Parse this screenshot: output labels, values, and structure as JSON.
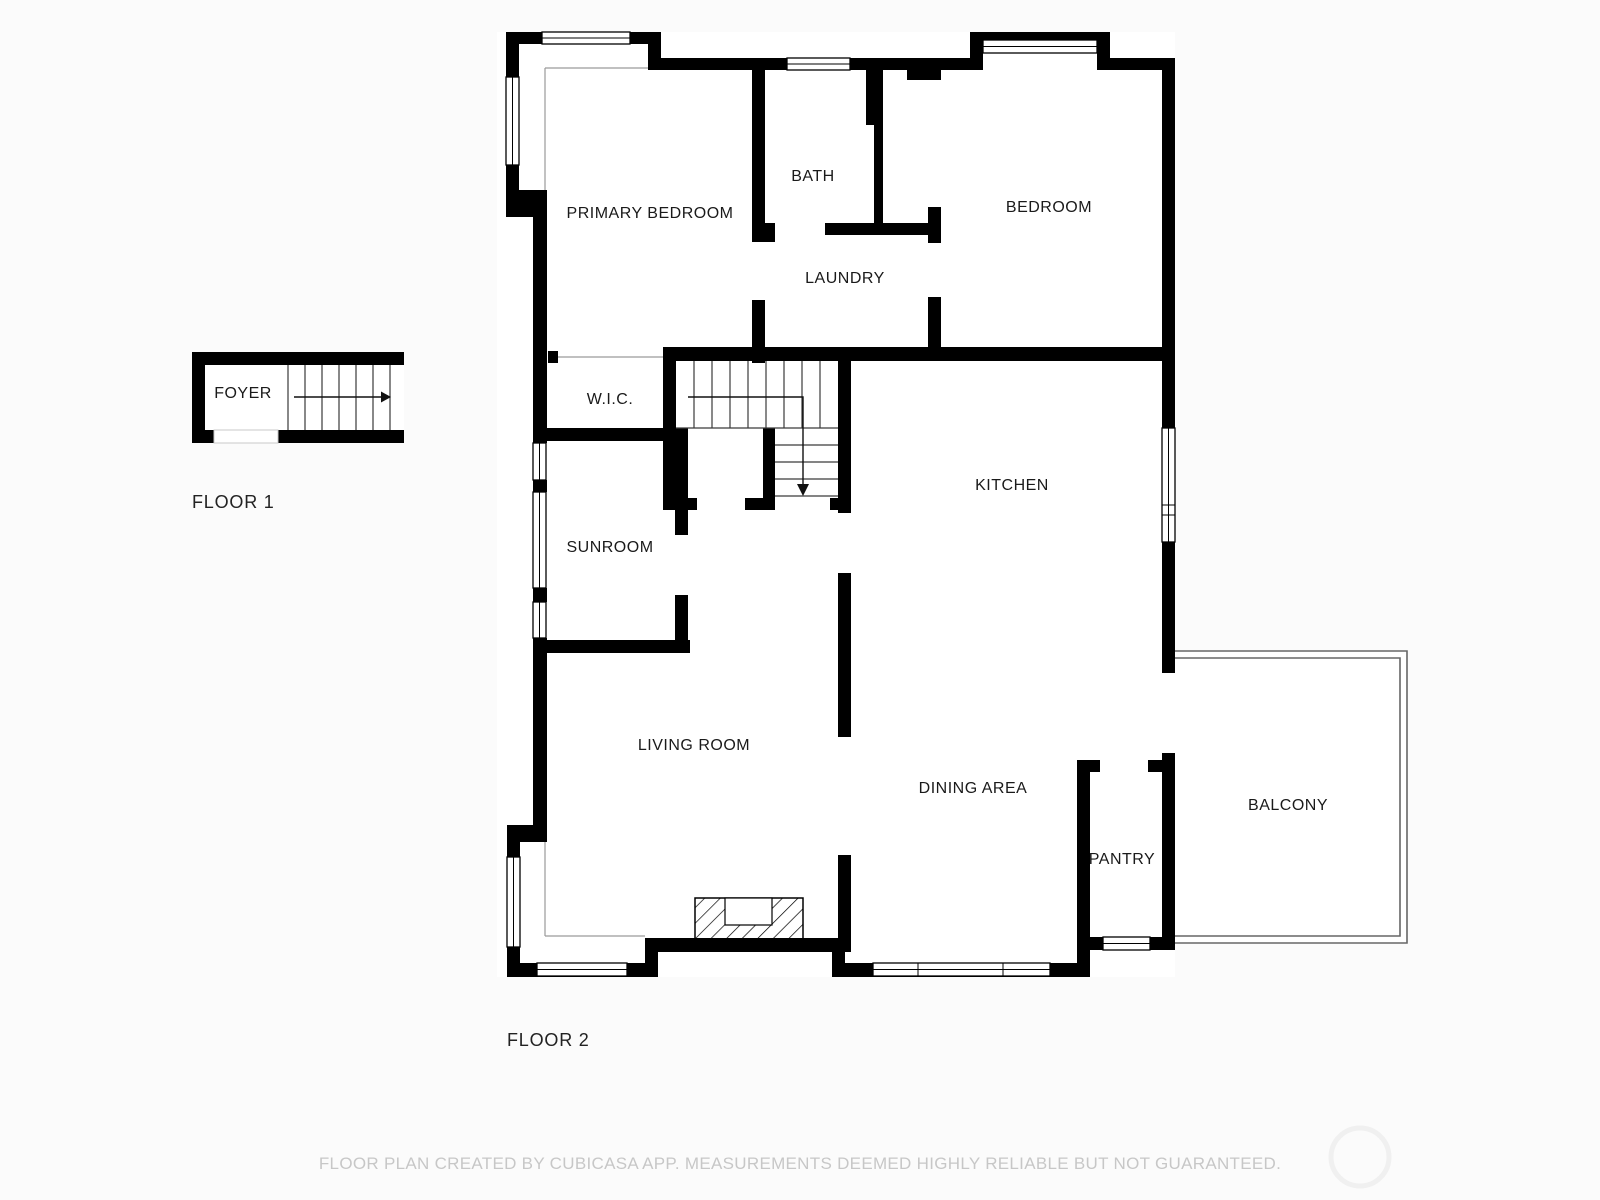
{
  "floor1": {
    "label": "FLOOR 1",
    "rooms": {
      "foyer": "FOYER"
    }
  },
  "floor2": {
    "label": "FLOOR 2",
    "rooms": {
      "primary_bedroom": "PRIMARY BEDROOM",
      "bath": "BATH",
      "bedroom": "BEDROOM",
      "laundry": "LAUNDRY",
      "wic": "W.I.C.",
      "kitchen": "KITCHEN",
      "sunroom": "SUNROOM",
      "living_room": "LIVING ROOM",
      "dining_area": "DINING AREA",
      "pantry": "PANTRY",
      "balcony": "BALCONY"
    }
  },
  "footer": {
    "disclaimer": "FLOOR PLAN CREATED BY CUBICASA APP. MEASUREMENTS DEEMED HIGHLY RELIABLE BUT NOT GUARANTEED."
  },
  "colors": {
    "wall": "#000000",
    "room_fill": "#ffffff",
    "background": "#fbfbfb",
    "label_text": "#1a1a1a",
    "floor_label_text": "#222222",
    "footer_text": "#c7c7c7",
    "stair_line": "#3a3a3a",
    "thin_line": "#9a9a9a",
    "balcony_line": "#666666",
    "watermark": "#f0f0f0"
  }
}
